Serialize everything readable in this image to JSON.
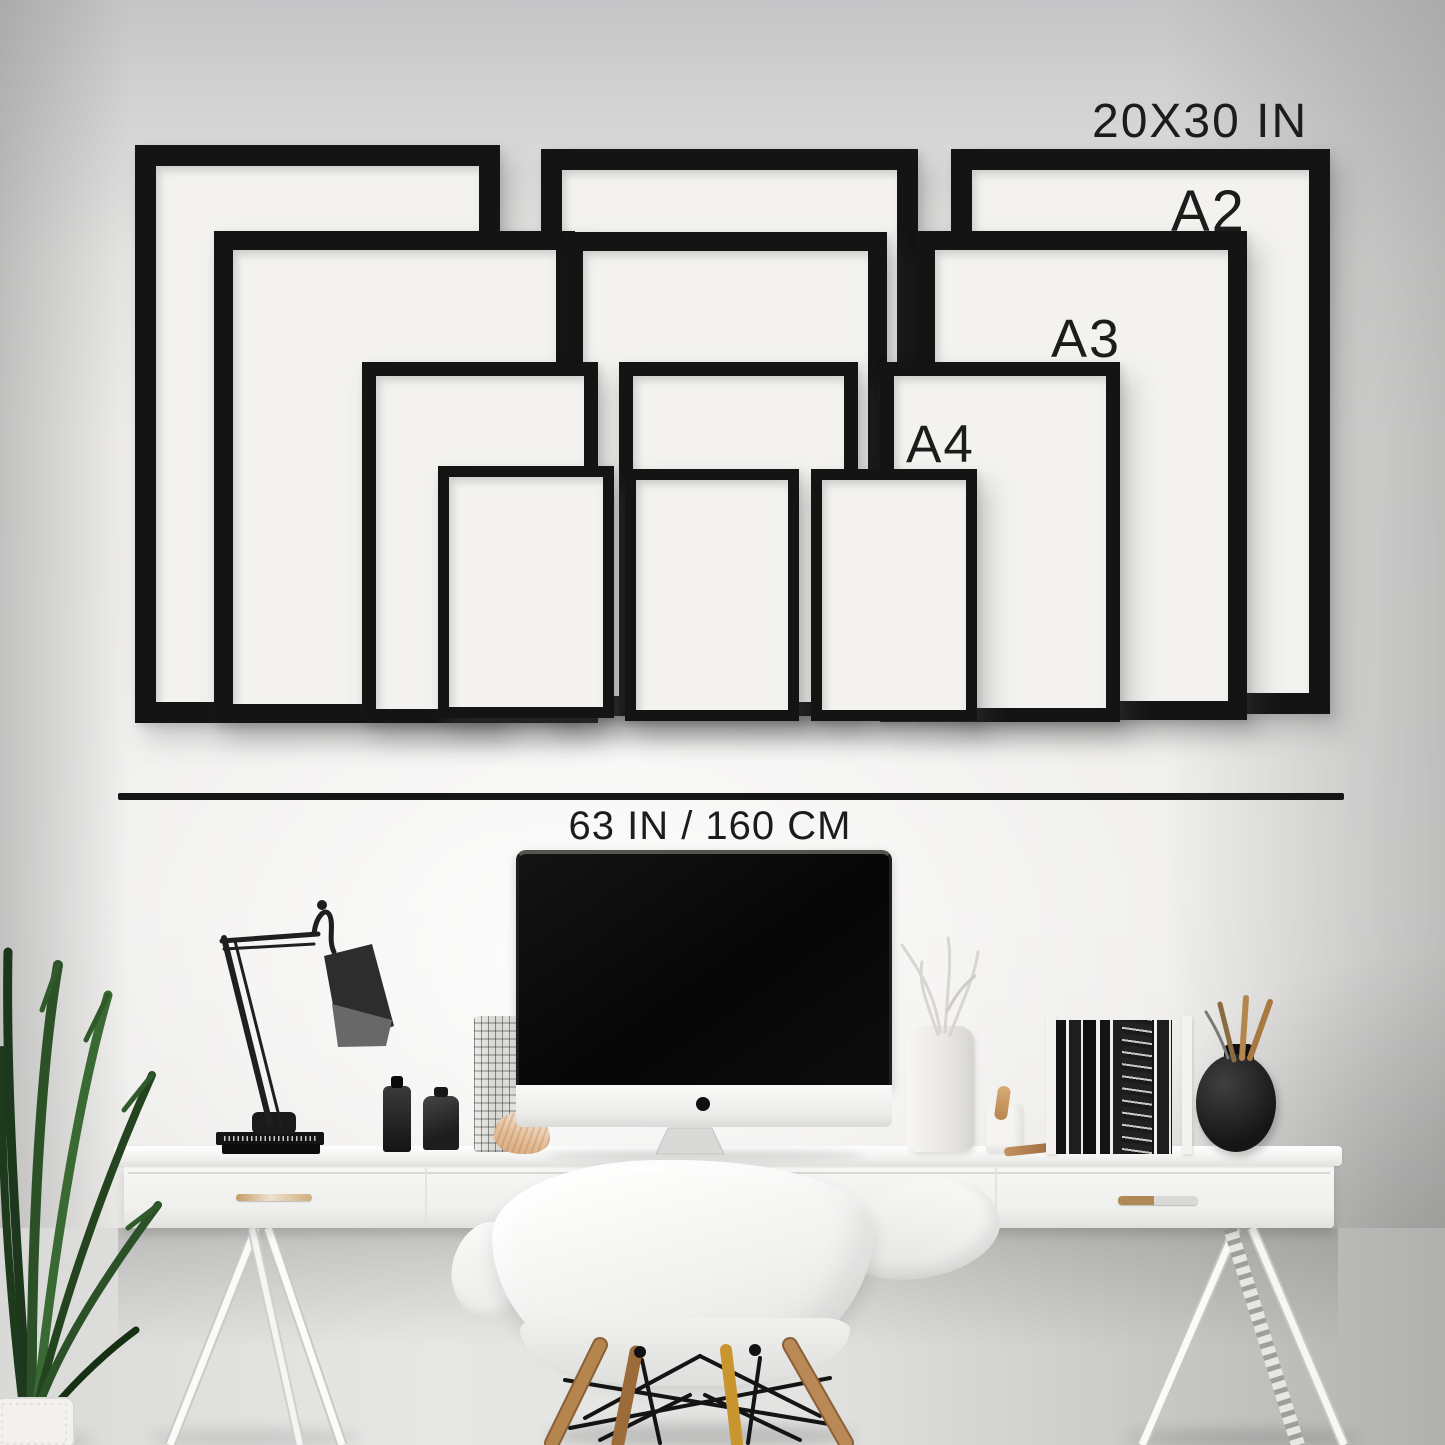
{
  "scene_title": "Frame size guide gallery wall above white desk workspace",
  "labels": {
    "frame_xl": "20X30 IN",
    "frame_a2": "A2",
    "frame_a3": "A3",
    "frame_a4": "A4",
    "wall_width": "63 IN / 160 CM"
  },
  "size_guide": [
    {
      "label": "20X30 IN",
      "frames_on_wall": 3
    },
    {
      "label": "A2",
      "frames_on_wall": 3
    },
    {
      "label": "A3",
      "frames_on_wall": 3
    },
    {
      "label": "A4",
      "frames_on_wall": 3
    }
  ],
  "colors": {
    "frame_moulding": "#161616",
    "label_text": "#1c1c1c",
    "wall_light": "#f1f0ee",
    "wall_shadow": "#c5c5c7",
    "desk_white": "#f6f6f4",
    "chair_wood_leg": "#b5854e",
    "plant_green": "#2c5129"
  },
  "objects": [
    "desk-lamp",
    "imac-computer",
    "white-trestle-desk",
    "eames-style-chair",
    "potted-plant",
    "white-vase-with-branches",
    "magazine-file-with-books",
    "black-round-vase",
    "small-bottles",
    "drawer-handles"
  ]
}
